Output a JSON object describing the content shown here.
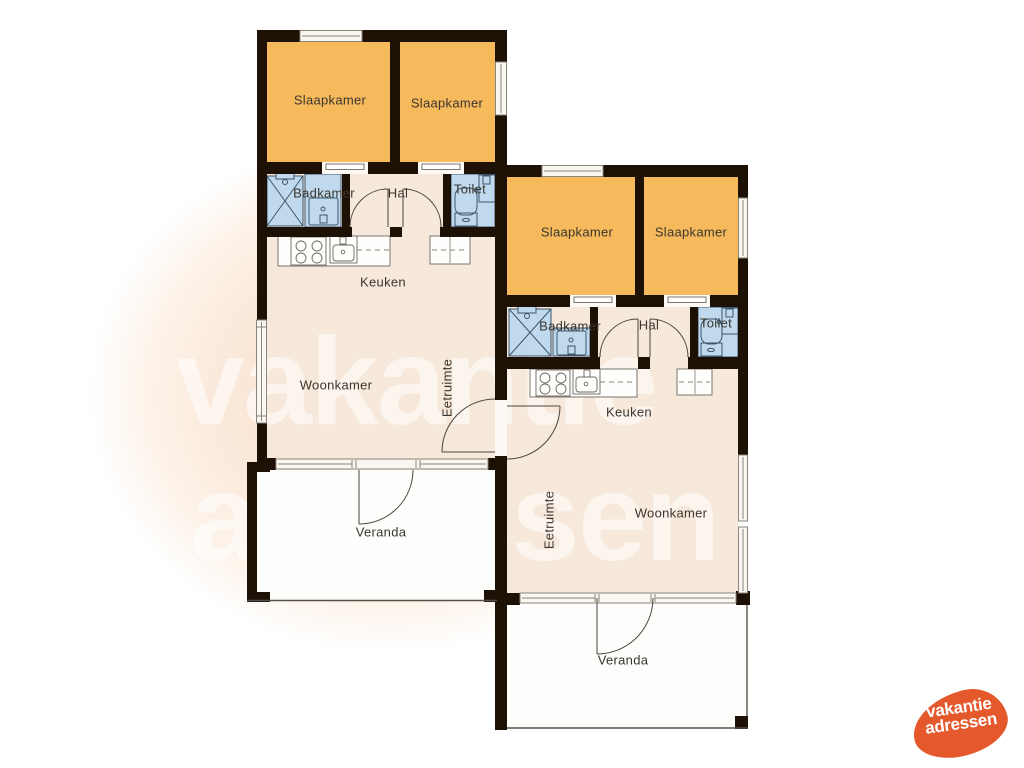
{
  "watermark": {
    "line1": "vakantie",
    "line2": "adressen"
  },
  "logo": {
    "line1": "vakantie",
    "line2": "adressen",
    "color": "#e4582b"
  },
  "palette": {
    "wall": "#1d1106",
    "bedroom_fill": "#f6b95b",
    "floor_fill": "#f6e8da",
    "veranda_fill": "#fdfdfb",
    "fixture_fill": "#c0d9ec",
    "fixture_stroke": "#3e556b",
    "background_blob": "#f8e1cf",
    "logo_orange": "#e4582b"
  },
  "units": [
    {
      "name": "left-cottage",
      "labels": {
        "bedroom_a": "Slaapkamer",
        "bedroom_b": "Slaapkamer",
        "bathroom": "Badkamer",
        "hall": "Hal",
        "toilet": "Toilet",
        "kitchen": "Keuken",
        "living_room": "Woonkamer",
        "dining_area": "Eetruimte",
        "veranda": "Veranda"
      }
    },
    {
      "name": "right-cottage",
      "labels": {
        "bedroom_a": "Slaapkamer",
        "bedroom_b": "Slaapkamer",
        "bathroom": "Badkamer",
        "hall": "Hal",
        "toilet": "Toilet",
        "kitchen": "Keuken",
        "living_room": "Woonkamer",
        "dining_area": "Eetruimte",
        "veranda": "Veranda"
      }
    }
  ]
}
